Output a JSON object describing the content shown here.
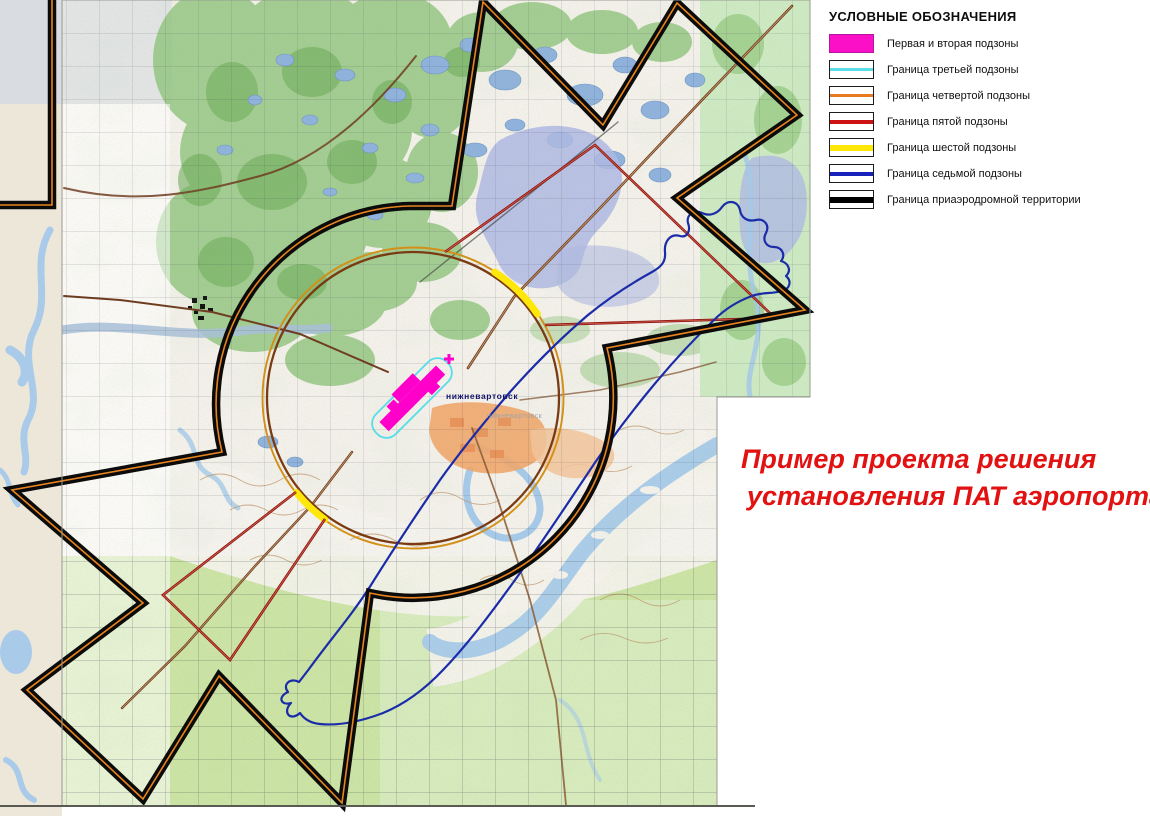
{
  "legend": {
    "title": "УСЛОВНЫЕ ОБОЗНАЧЕНИЯ",
    "items": [
      {
        "label": "Первая и вторая подзоны",
        "color": "#fb10c8",
        "swatch": "filled"
      },
      {
        "label": "Граница третьей подзоны",
        "color": "#5bdde8",
        "swatch": "line"
      },
      {
        "label": "Граница четвертой подзоны",
        "color": "#e87a22",
        "swatch": "line"
      },
      {
        "label": "Граница пятой подзоны",
        "color": "#cc1212",
        "swatch": "line"
      },
      {
        "label": "Граница шестой подзоны",
        "color": "#ffe70a",
        "swatch": "thick-line"
      },
      {
        "label": "Граница седьмой подзоны",
        "color": "#1822bb",
        "swatch": "line"
      },
      {
        "label": "Граница приаэродромной территории",
        "color": "#000000",
        "swatch": "thick-line"
      }
    ]
  },
  "annotation": {
    "line1": "Пример проекта решения",
    "line2": "установления ПАТ аэропорта",
    "color": "#e21212"
  },
  "map": {
    "city_label": "нижневартовск",
    "city_label_ghost": "нижневартовск",
    "colors": {
      "margin_paper": "#ede7d9",
      "map_base": "#f2f0e9",
      "aerodrome_boundary": "#0b0b0b",
      "aerodrome_boundary_stripe": "#e8841e",
      "subzone_circle_brown": "#7a3a12",
      "subzone_circle_gold": "#d29018",
      "sixth_subzone_yellow": "#ffe70a",
      "fifth_subzone_red": "#8e1414",
      "seventh_subzone_blue": "#1b2ca8",
      "third_subzone_cyan": "#58dde8",
      "first_second_subzones_magenta": "#ff00cb",
      "forest_green": "#8fc47c",
      "water_blue": "#8fb2dc"
    }
  }
}
